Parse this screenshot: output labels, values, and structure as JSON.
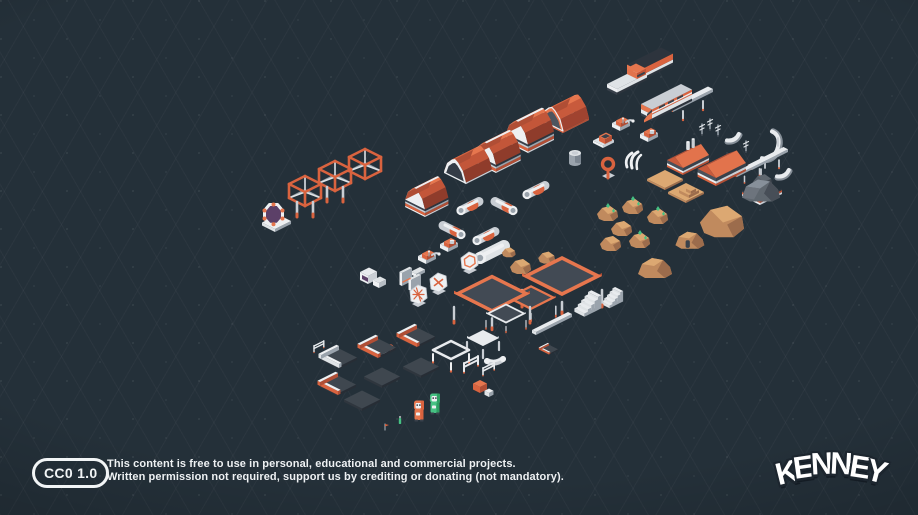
{
  "page": {
    "width": 918,
    "height": 515
  },
  "background": {
    "base": "#243039",
    "grid_line": "#2c3a46",
    "vignette": "#18222c"
  },
  "palette": {
    "orange": "#d9633f",
    "orange_bright": "#e6764e",
    "orange_light": "#ee8a60",
    "orange_dark": "#b04e35",
    "orange_deep": "#8f3c2b",
    "white": "#eef0f2",
    "white_dim": "#dfe3e6",
    "light": "#c9ced4",
    "mid": "#9aa3ac",
    "steel": "#7b8590",
    "dark": "#39414b",
    "darker": "#2d343d",
    "tile_top": "#3f474f",
    "tan": "#dca872",
    "tan_mid": "#c08a5e",
    "tan_dark": "#9c6c4c",
    "gray_top": "#87909a",
    "gray_side": "#5f676f",
    "gray_deep": "#474e57",
    "green": "#46c183",
    "green_dark": "#2f9e63",
    "purple": "#5c4068"
  },
  "license": {
    "badge": "CC0 1.0",
    "line1": "This content is free to use in personal, educational and commercial projects.",
    "line2": "Written permission not required, support us by crediting or donating (not mandatory)."
  },
  "logo": {
    "text": "KENNEY"
  },
  "models": [
    {
      "t": "wagon",
      "n": "monorail-wagon",
      "x": 639,
      "y": 82
    },
    {
      "t": "flatcar",
      "n": "monorail-flatcar",
      "x": 617,
      "y": 95
    },
    {
      "t": "train",
      "n": "monorail-train",
      "x": 652,
      "y": 121
    },
    {
      "t": "rail",
      "n": "track-straight",
      "x": 673,
      "y": 112
    },
    {
      "t": "rail",
      "n": "track-straight",
      "x": 752,
      "y": 170,
      "s": 0.9
    },
    {
      "t": "rail",
      "n": "track-straight",
      "x": 737,
      "y": 177,
      "s": 0.75
    },
    {
      "t": "curve",
      "n": "track-curve",
      "x": 727,
      "y": 142
    },
    {
      "t": "curve",
      "n": "track-curve",
      "x": 762,
      "y": 160,
      "v": 1
    },
    {
      "t": "curve",
      "n": "track-curve",
      "x": 777,
      "y": 178
    },
    {
      "t": "antenna",
      "n": "antenna",
      "x": 702,
      "y": 135
    },
    {
      "t": "antenna",
      "n": "antenna",
      "x": 710,
      "y": 130
    },
    {
      "t": "antenna",
      "n": "antenna",
      "x": 718,
      "y": 136
    },
    {
      "t": "antenna",
      "n": "antenna",
      "x": 746,
      "y": 152
    },
    {
      "t": "machine",
      "n": "robot-machine",
      "x": 620,
      "y": 131
    },
    {
      "t": "machine",
      "n": "robot-machine",
      "x": 648,
      "y": 142,
      "v": 1
    },
    {
      "t": "hexmachine",
      "n": "hex-pod",
      "x": 603,
      "y": 148
    },
    {
      "t": "ringtool",
      "n": "ring-antenna",
      "x": 608,
      "y": 179
    },
    {
      "t": "tank",
      "n": "storage-tank",
      "x": 575,
      "y": 169
    },
    {
      "t": "claws",
      "n": "white-horns",
      "x": 627,
      "y": 167
    },
    {
      "t": "factory",
      "n": "factory-building",
      "x": 683,
      "y": 175
    },
    {
      "t": "factory",
      "n": "factory-building",
      "x": 716,
      "y": 186,
      "s": 1.15,
      "v": 1
    },
    {
      "t": "graydome",
      "n": "gray-dome",
      "x": 760,
      "y": 205
    },
    {
      "t": "rock",
      "n": "dark-rock",
      "x": 763,
      "y": 186,
      "v": 2,
      "s": 0.9
    },
    {
      "t": "tantile",
      "n": "terrain-tile",
      "x": 665,
      "y": 190
    },
    {
      "t": "tantile",
      "n": "terrain-tile-steps",
      "x": 686,
      "y": 203,
      "v": 1
    },
    {
      "t": "rock",
      "n": "crystal-rock",
      "x": 608,
      "y": 219,
      "v": 1
    },
    {
      "t": "rock",
      "n": "crystal-rock",
      "x": 633,
      "y": 212,
      "v": 1
    },
    {
      "t": "rock",
      "n": "rock",
      "x": 622,
      "y": 234
    },
    {
      "t": "rock",
      "n": "crystal-rock",
      "x": 658,
      "y": 222,
      "v": 1
    },
    {
      "t": "rock",
      "n": "rock",
      "x": 611,
      "y": 249
    },
    {
      "t": "rock",
      "n": "crystal-rock",
      "x": 640,
      "y": 246,
      "v": 1
    },
    {
      "t": "rock",
      "n": "big-rock",
      "x": 723,
      "y": 233,
      "s": 2.1
    },
    {
      "t": "tandome",
      "n": "rock-habitat",
      "x": 689,
      "y": 247,
      "s": 0.85,
      "v": 1
    },
    {
      "t": "tandome",
      "n": "rock-dome",
      "x": 654,
      "y": 276
    },
    {
      "t": "rock",
      "n": "rock",
      "x": 521,
      "y": 272
    },
    {
      "t": "rock",
      "n": "rock",
      "x": 547,
      "y": 262,
      "s": 0.8
    },
    {
      "t": "rock",
      "n": "rock",
      "x": 509,
      "y": 256,
      "s": 0.65
    },
    {
      "t": "hangaropen",
      "n": "hangar-frame",
      "x": 563,
      "y": 133
    },
    {
      "t": "hangar",
      "n": "hangar",
      "x": 528,
      "y": 153
    },
    {
      "t": "hangar",
      "n": "hangar",
      "x": 496,
      "y": 173,
      "s": 0.95
    },
    {
      "t": "arch",
      "n": "hangar-tunnel",
      "x": 466,
      "y": 184
    },
    {
      "t": "hangar",
      "n": "hangar",
      "x": 425,
      "y": 217,
      "s": 0.9
    },
    {
      "t": "pipe",
      "n": "pipe",
      "x": 470,
      "y": 206
    },
    {
      "t": "pipe",
      "n": "pipe",
      "x": 504,
      "y": 206,
      "v": 1
    },
    {
      "t": "pipe",
      "n": "pipe",
      "x": 536,
      "y": 190
    },
    {
      "t": "pipe",
      "n": "pipe",
      "x": 452,
      "y": 230,
      "v": 1
    },
    {
      "t": "pipe",
      "n": "pipe",
      "x": 486,
      "y": 236
    },
    {
      "t": "pipe",
      "n": "large-tube",
      "x": 492,
      "y": 252,
      "v": 2
    },
    {
      "t": "truss",
      "n": "truss-cube",
      "x": 305,
      "y": 206
    },
    {
      "t": "truss",
      "n": "truss-cube",
      "x": 335,
      "y": 191
    },
    {
      "t": "truss",
      "n": "truss-cube",
      "x": 365,
      "y": 179,
      "v": 1
    },
    {
      "t": "portal",
      "n": "portal-gate",
      "x": 273,
      "y": 231
    },
    {
      "t": "ship",
      "n": "spaceship",
      "x": 352,
      "y": 248,
      "v": 0
    },
    {
      "t": "ship",
      "n": "spaceship",
      "x": 255,
      "y": 258,
      "v": 4,
      "s": 0.75
    },
    {
      "t": "ship",
      "n": "spaceship",
      "x": 296,
      "y": 284,
      "v": 1
    },
    {
      "t": "ship",
      "n": "spaceship",
      "x": 250,
      "y": 315,
      "v": 0,
      "s": 0.95
    },
    {
      "t": "ship",
      "n": "spaceship",
      "x": 204,
      "y": 343,
      "v": 4,
      "s": 0.85
    },
    {
      "t": "ship",
      "n": "spaceship",
      "x": 324,
      "y": 338,
      "v": 2
    },
    {
      "t": "ship",
      "n": "spaceship",
      "x": 261,
      "y": 371,
      "v": 3
    },
    {
      "t": "wrench",
      "n": "tool",
      "x": 384,
      "y": 353
    },
    {
      "t": "monitor",
      "n": "crate-monitor",
      "x": 368,
      "y": 284
    },
    {
      "t": "doors",
      "n": "door-panels",
      "x": 402,
      "y": 286
    },
    {
      "t": "hexpanel",
      "n": "hex-panel",
      "x": 469,
      "y": 274,
      "v": 0
    },
    {
      "t": "hexpanel",
      "n": "hex-panel",
      "x": 438,
      "y": 295,
      "v": 1
    },
    {
      "t": "hexpanel",
      "n": "hex-panel",
      "x": 418,
      "y": 307,
      "v": 2
    },
    {
      "t": "machine",
      "n": "small-machine",
      "x": 448,
      "y": 252,
      "v": 1
    },
    {
      "t": "machine",
      "n": "small-machine",
      "x": 426,
      "y": 264
    },
    {
      "t": "wedge",
      "n": "ramp-block",
      "x": 416,
      "y": 277
    },
    {
      "t": "platform",
      "n": "platform-large",
      "x": 562,
      "y": 309
    },
    {
      "t": "platform",
      "n": "platform-large",
      "x": 492,
      "y": 325,
      "s": 0.95
    },
    {
      "t": "platform",
      "n": "platform-medium",
      "x": 531,
      "y": 318,
      "s": 0.62
    },
    {
      "t": "platform",
      "n": "platform-small",
      "x": 506,
      "y": 330,
      "s": 0.5,
      "v": 1
    },
    {
      "t": "tile",
      "n": "floor-tile-small",
      "x": 549,
      "y": 355,
      "s": 0.5
    },
    {
      "t": "stairs",
      "n": "stairs",
      "x": 590,
      "y": 314
    },
    {
      "t": "stairs",
      "n": "stairs",
      "x": 614,
      "y": 306,
      "s": 0.8
    },
    {
      "t": "beam",
      "n": "beam",
      "x": 536,
      "y": 335
    },
    {
      "t": "tile",
      "n": "floor-tile",
      "x": 417,
      "y": 348
    },
    {
      "t": "tile",
      "n": "floor-tile",
      "x": 378,
      "y": 359
    },
    {
      "t": "tile",
      "n": "floor-tile",
      "x": 339,
      "y": 369,
      "v": 1
    },
    {
      "t": "tile",
      "n": "floor-tile",
      "x": 421,
      "y": 378,
      "v": 2
    },
    {
      "t": "tile",
      "n": "floor-tile",
      "x": 382,
      "y": 388,
      "v": 2
    },
    {
      "t": "tile",
      "n": "floor-tile",
      "x": 338,
      "y": 396
    },
    {
      "t": "tile",
      "n": "floor-tile",
      "x": 362,
      "y": 411,
      "v": 2
    },
    {
      "t": "table",
      "n": "table",
      "x": 483,
      "y": 354
    },
    {
      "t": "frame",
      "n": "railing-frame",
      "x": 451,
      "y": 367
    },
    {
      "t": "fence",
      "n": "fence",
      "x": 464,
      "y": 372
    },
    {
      "t": "fence",
      "n": "fence",
      "x": 483,
      "y": 375,
      "s": 0.8
    },
    {
      "t": "fence",
      "n": "fence",
      "x": 314,
      "y": 352,
      "s": 0.7
    },
    {
      "t": "crate",
      "n": "crates",
      "x": 480,
      "y": 393
    },
    {
      "t": "char",
      "n": "astronaut-orange",
      "x": 419,
      "y": 420,
      "v": 0
    },
    {
      "t": "char",
      "n": "astronaut-green",
      "x": 435,
      "y": 413,
      "v": 1
    },
    {
      "t": "bottle",
      "n": "canister",
      "x": 400,
      "y": 424
    },
    {
      "t": "flag",
      "n": "marker",
      "x": 385,
      "y": 430
    },
    {
      "t": "cornerpipe",
      "n": "pipe-corner",
      "x": 495,
      "y": 358
    }
  ]
}
